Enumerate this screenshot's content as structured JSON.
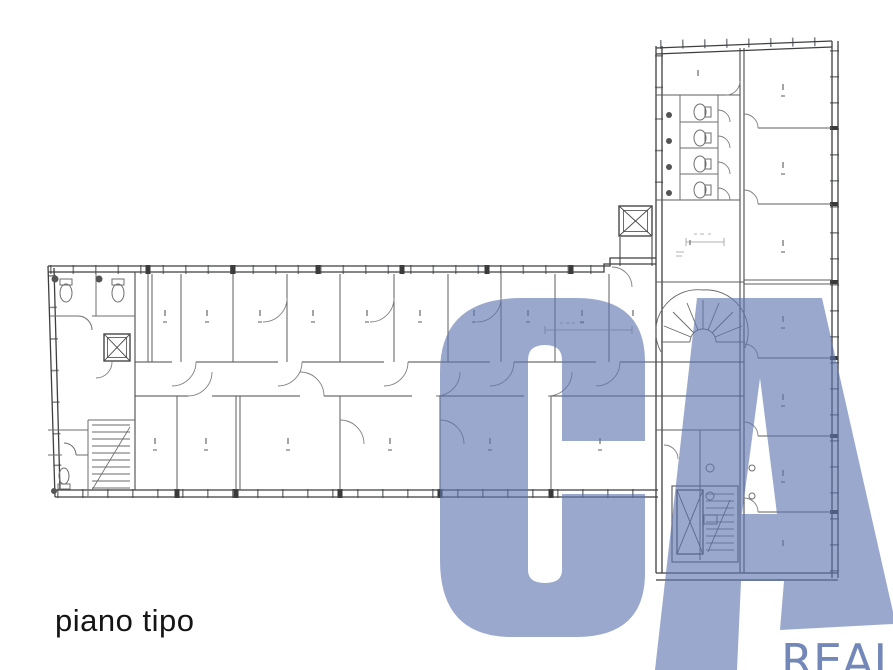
{
  "page": {
    "background_color": "#ffffff"
  },
  "caption": {
    "label": "piano tipo"
  },
  "watermark": {
    "letters": "CA",
    "brand_line": "REAL",
    "color": "#5a73ad",
    "opacity": 0.62,
    "brand_opacity": 0.85
  },
  "plan": {
    "kind": "architectural floor plan, L-shaped office building",
    "wall_color": "#3f3f3f",
    "partition_color": "#5c5c5c",
    "window_tick_color": "#878b90"
  }
}
